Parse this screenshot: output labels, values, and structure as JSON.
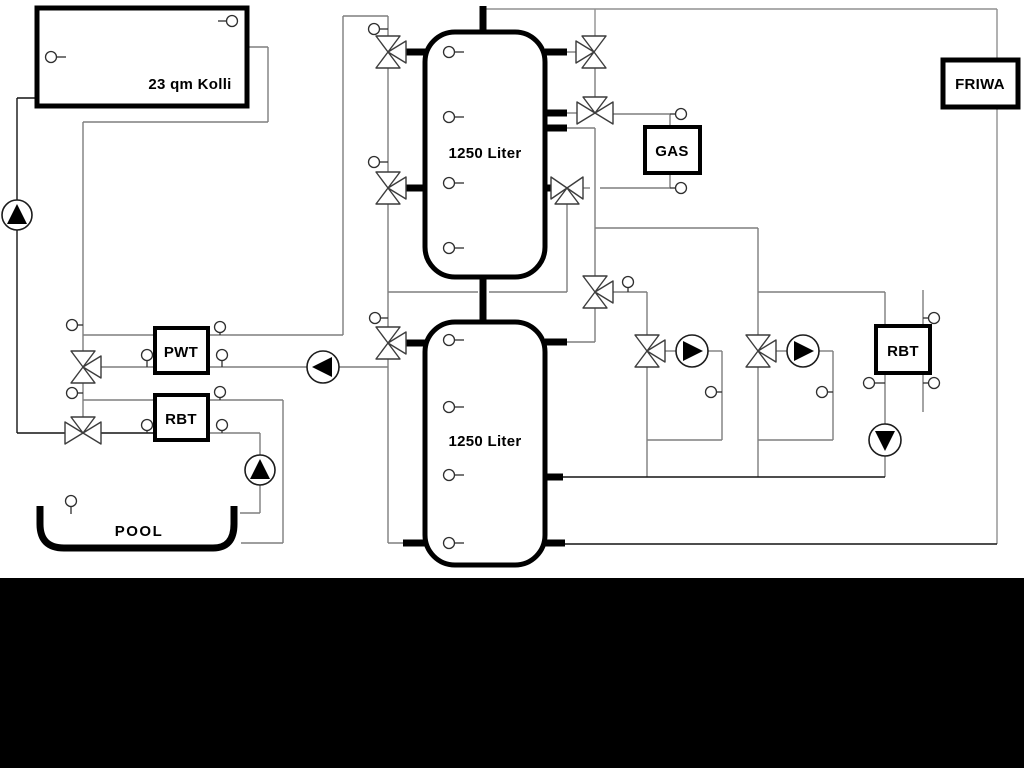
{
  "diagram": {
    "type": "hydraulic-heating-schematic",
    "background_color": "#ffffff",
    "bottom_band_color": "#000000",
    "pipe_color_gray": "#7e7e7e",
    "pipe_color_dark": "#141414",
    "labels": {
      "collector": "23 qm Kolli",
      "buffer_tank_top": "1250 Liter",
      "buffer_tank_bottom": "1250 Liter",
      "pwt": "PWT",
      "rbt_left": "RBT",
      "gas": "GAS",
      "rbt_right": "RBT",
      "friwa": "FRIWA",
      "pool": "POOL"
    },
    "icons": {
      "pump-icon": "circle with solid triangle indicating flow direction",
      "three-way-valve-icon": "triangle bowtie valve symbol",
      "sensor-icon": "small circle temperature probe with stem"
    }
  }
}
